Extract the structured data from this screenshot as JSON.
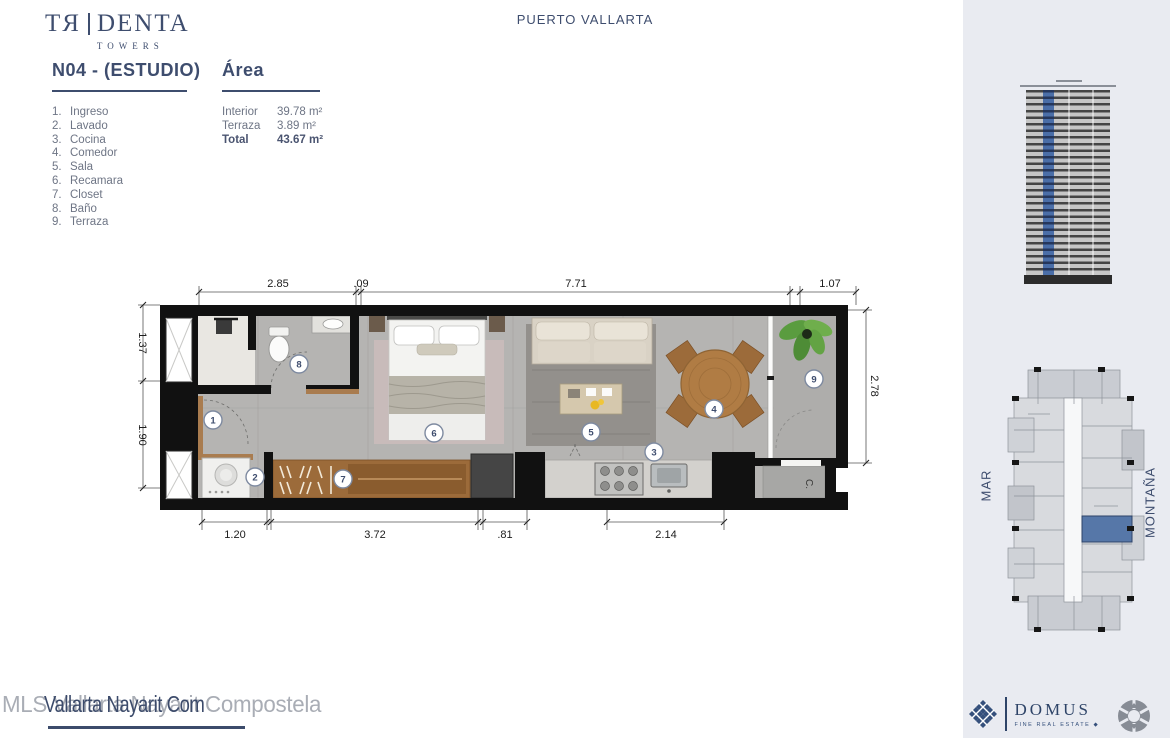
{
  "brand": {
    "wordmark_left": "TЯ",
    "wordmark_right": "DENTA",
    "subtitle": "TOWERS"
  },
  "header": {
    "unit_title": "N04 - (ESTUDIO)",
    "area_title": "Área"
  },
  "legend": {
    "items": [
      {
        "num": "1.",
        "label": "Ingreso"
      },
      {
        "num": "2.",
        "label": "Lavado"
      },
      {
        "num": "3.",
        "label": "Cocina"
      },
      {
        "num": "4.",
        "label": "Comedor"
      },
      {
        "num": "5.",
        "label": "Sala"
      },
      {
        "num": "6.",
        "label": "Recamara"
      },
      {
        "num": "7.",
        "label": "Closet"
      },
      {
        "num": "8.",
        "label": "Baño"
      },
      {
        "num": "9.",
        "label": "Terraza"
      }
    ]
  },
  "area": {
    "rows": [
      {
        "label": "Interior",
        "value": "39.78 m²"
      },
      {
        "label": "Terraza",
        "value": "3.89 m²"
      },
      {
        "label": "Total",
        "value": "43.67 m²"
      }
    ]
  },
  "plan": {
    "dims_top": [
      "2.85",
      ".09",
      "7.71",
      "1.07"
    ],
    "dims_bottom": [
      "1.20",
      "3.72",
      ".81",
      "2.14"
    ],
    "dims_left": [
      "1.37",
      "1.90"
    ],
    "dims_right": [
      "2.78"
    ],
    "room_numbers": [
      "1",
      "2",
      "3",
      "4",
      "5",
      "6",
      "7",
      "8",
      "9"
    ],
    "closet_label": "C."
  },
  "sidebar": {
    "location": "PUERTO VALLARTA",
    "orientation_left": "MAR",
    "orientation_right": "MONTAÑA"
  },
  "footer": {
    "watermark_gray": "MLS Vallarta Nayarit Compostela",
    "watermark_dark": "Vallarta Nayarit Com",
    "domus_name": "DOMUS",
    "domus_tagline": "FINE REAL ESTATE  ◆"
  },
  "colors": {
    "navy": "#3e4d6e",
    "sidebar_bg": "#e9ebf1",
    "unit_highlight": "#5677a8"
  }
}
